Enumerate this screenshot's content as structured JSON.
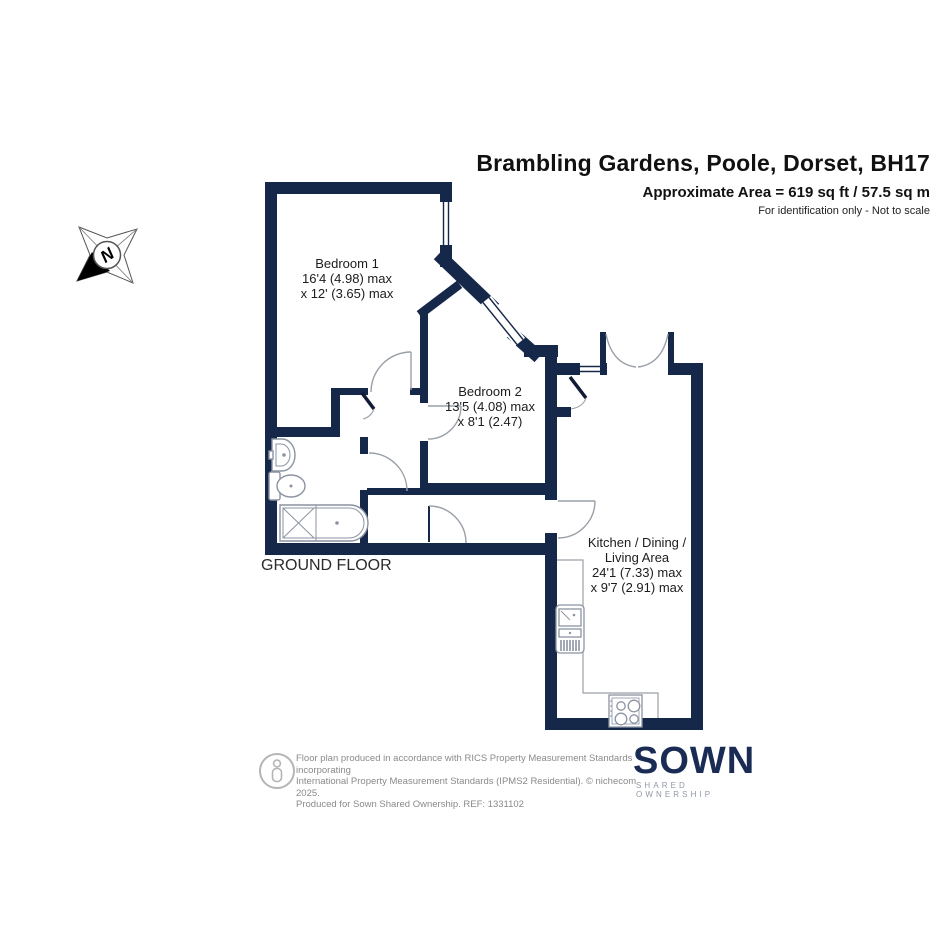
{
  "header": {
    "title": "Brambling Gardens, Poole, Dorset, BH17",
    "area": "Approximate Area = 619 sq ft / 57.5 sq m",
    "disclaimer": "For identification only - Not to scale"
  },
  "compass": {
    "north_label": "N"
  },
  "floor": {
    "label": "GROUND FLOOR"
  },
  "rooms": {
    "bedroom1": {
      "lines": [
        "Bedroom 1",
        "16'4 (4.98) max",
        "x 12' (3.65) max"
      ]
    },
    "bedroom2": {
      "lines": [
        "Bedroom 2",
        "13'5 (4.08) max",
        "x 8'1 (2.47)"
      ]
    },
    "kitchen": {
      "lines": [
        "Kitchen / Dining /",
        "Living Area",
        "24'1 (7.33) max",
        "x 9'7 (2.91) max"
      ]
    }
  },
  "footer": {
    "line1": "Floor plan produced in accordance with RICS Property Measurement Standards incorporating",
    "line2": "International Property Measurement Standards (IPMS2 Residential).   © nichecom 2025.",
    "line3": "Produced for Sown Shared Ownership.   REF:  1331102"
  },
  "logo": {
    "name": "SOWN",
    "tagline": "SHARED OWNERSHIP"
  },
  "colors": {
    "wall_navy": "#16284A",
    "logo_navy": "#1B2C54",
    "line_gray": "#9AA0A8",
    "fixture_gray": "#8B93A2"
  }
}
